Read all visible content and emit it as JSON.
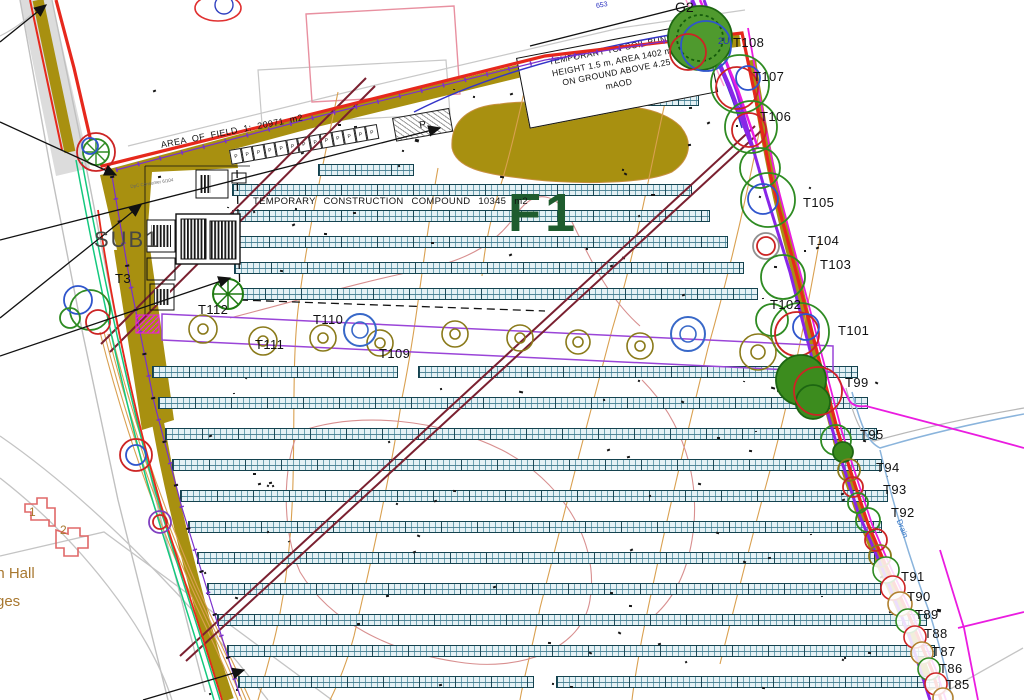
{
  "drawing": {
    "field_label": "F1",
    "grid_connection_label": "G2",
    "substation_label": "SUB1",
    "area_note": "AREA OF FIELD 1: 20971 m2",
    "compound_note": "TEMPORARY CONSTRUCTION COMPOUND 10345 m2",
    "bund_note_lines": [
      "TEMPORARY TOPSOIL BUND:",
      "HEIGHT 1.5 m, AREA 1402 m2",
      "ON GROUND ABOVE 4.25",
      "mAOD"
    ],
    "drain_label": "Drain",
    "level_note": "653",
    "pole_note": "2U",
    "equipment_note": "DpC Consumer 6/104",
    "parking_label": "P",
    "parking_bay_count": 13,
    "tree_labels": [
      {
        "text": "T108",
        "x": 733,
        "y": 36
      },
      {
        "text": "T107",
        "x": 753,
        "y": 70
      },
      {
        "text": "T106",
        "x": 760,
        "y": 110
      },
      {
        "text": "T105",
        "x": 803,
        "y": 196
      },
      {
        "text": "T104",
        "x": 808,
        "y": 234
      },
      {
        "text": "T103",
        "x": 820,
        "y": 258
      },
      {
        "text": "T102",
        "x": 770,
        "y": 298
      },
      {
        "text": "T101",
        "x": 838,
        "y": 324
      },
      {
        "text": "T99",
        "x": 845,
        "y": 376
      },
      {
        "text": "T95",
        "x": 860,
        "y": 428
      },
      {
        "text": "T94",
        "x": 876,
        "y": 461
      },
      {
        "text": "T93",
        "x": 883,
        "y": 483
      },
      {
        "text": "T92",
        "x": 891,
        "y": 506
      },
      {
        "text": "T91",
        "x": 901,
        "y": 570
      },
      {
        "text": "T90",
        "x": 907,
        "y": 590
      },
      {
        "text": "T89",
        "x": 915,
        "y": 608
      },
      {
        "text": "T88",
        "x": 924,
        "y": 627
      },
      {
        "text": "T87",
        "x": 932,
        "y": 645
      },
      {
        "text": "T86",
        "x": 939,
        "y": 662
      },
      {
        "text": "T85",
        "x": 946,
        "y": 678
      },
      {
        "text": "T112",
        "x": 198,
        "y": 303
      },
      {
        "text": "T110",
        "x": 313,
        "y": 313
      },
      {
        "text": "T111",
        "x": 255,
        "y": 338
      },
      {
        "text": "T109",
        "x": 379,
        "y": 347
      },
      {
        "text": "T3",
        "x": 115,
        "y": 272
      }
    ],
    "place_labels": [
      {
        "text": "on Hall",
        "x": -12,
        "y": 566,
        "size": 15
      },
      {
        "text": "ges",
        "x": -4,
        "y": 594,
        "size": 15
      },
      {
        "text": "1",
        "x": 29,
        "y": 506,
        "size": 12
      },
      {
        "text": "2",
        "x": 60,
        "y": 524,
        "size": 12
      }
    ],
    "colors": {
      "boundary_red": "#e6281c",
      "fence_purple": "#7a30cc",
      "road_violet": "#8826e8",
      "road_magenta": "#ea1ce0",
      "bund_olive": "#a89010",
      "panel_fill": "#e4f1f5",
      "panel_grid": "#3a8096",
      "panel_border": "#14424e",
      "tree_green": "#2e8b22",
      "tree_red": "#cc2424",
      "tree_blue": "#2f55cc",
      "hedge_olive": "#8a7a1a",
      "contour_tan": "#d9a050",
      "contour_salmon": "#d88f8f",
      "ohl_maroon": "#7a2030",
      "teal_green": "#14c87e",
      "drain_blue": "#8ab4dc",
      "field_label_green": "#1e5c2e",
      "place_label_brown": "#a87830",
      "building_red": "#e06868"
    }
  },
  "site_plan": {
    "panel_row_height": 12,
    "panel_rows": [
      {
        "x": 633,
        "y": 74,
        "w": 58
      },
      {
        "x": 533,
        "y": 94,
        "w": 166
      },
      {
        "x": 318,
        "y": 164,
        "w": 96
      },
      {
        "x": 232,
        "y": 184,
        "w": 460
      },
      {
        "x": 232,
        "y": 210,
        "w": 478
      },
      {
        "x": 232,
        "y": 236,
        "w": 496
      },
      {
        "x": 234,
        "y": 262,
        "w": 510
      },
      {
        "x": 228,
        "y": 288,
        "w": 530
      },
      {
        "x": 152,
        "y": 366,
        "w": 246
      },
      {
        "x": 418,
        "y": 366,
        "w": 440
      },
      {
        "x": 158,
        "y": 397,
        "w": 710
      },
      {
        "x": 165,
        "y": 428,
        "w": 712
      },
      {
        "x": 172,
        "y": 459,
        "w": 710
      },
      {
        "x": 180,
        "y": 490,
        "w": 708
      },
      {
        "x": 188,
        "y": 521,
        "w": 694
      },
      {
        "x": 197,
        "y": 552,
        "w": 678
      },
      {
        "x": 207,
        "y": 583,
        "w": 674
      },
      {
        "x": 217,
        "y": 614,
        "w": 710
      },
      {
        "x": 227,
        "y": 645,
        "w": 708
      },
      {
        "x": 238,
        "y": 676,
        "w": 296
      },
      {
        "x": 556,
        "y": 676,
        "w": 384
      }
    ]
  }
}
